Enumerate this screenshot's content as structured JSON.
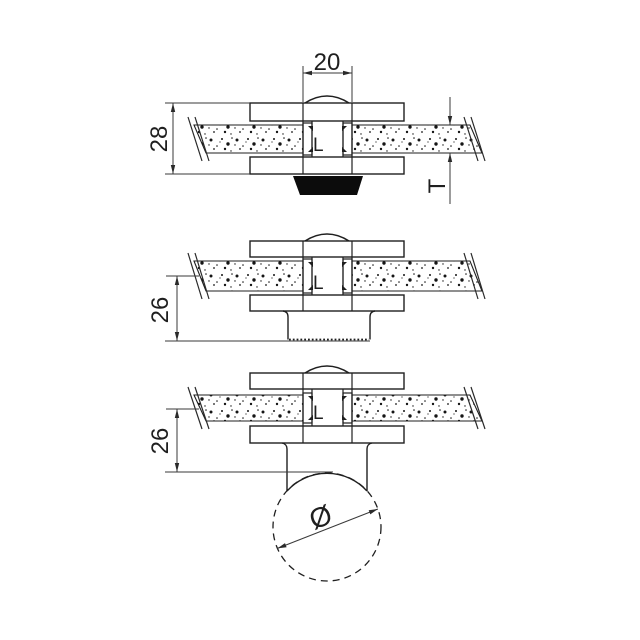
{
  "title": "glass clamp technical drawing, three section views",
  "colors": {
    "background": "#ffffff",
    "ink": "#1f1f1f",
    "dim_ink": "#3a3a3a",
    "screw_head_fill": "#0c0c0c"
  },
  "views": [
    {
      "name": "section with countersunk screw head",
      "dims": {
        "slot_width": "20",
        "overall_height": "28",
        "glass_thickness": "T"
      },
      "glass_label": "L"
    },
    {
      "name": "section with flat knurled base",
      "dims": {
        "base_depth": "26"
      },
      "glass_label": "L"
    },
    {
      "name": "section mounted on round tube",
      "dims": {
        "base_depth": "26",
        "tube_diameter": "Ø"
      },
      "glass_label": "L"
    }
  ]
}
